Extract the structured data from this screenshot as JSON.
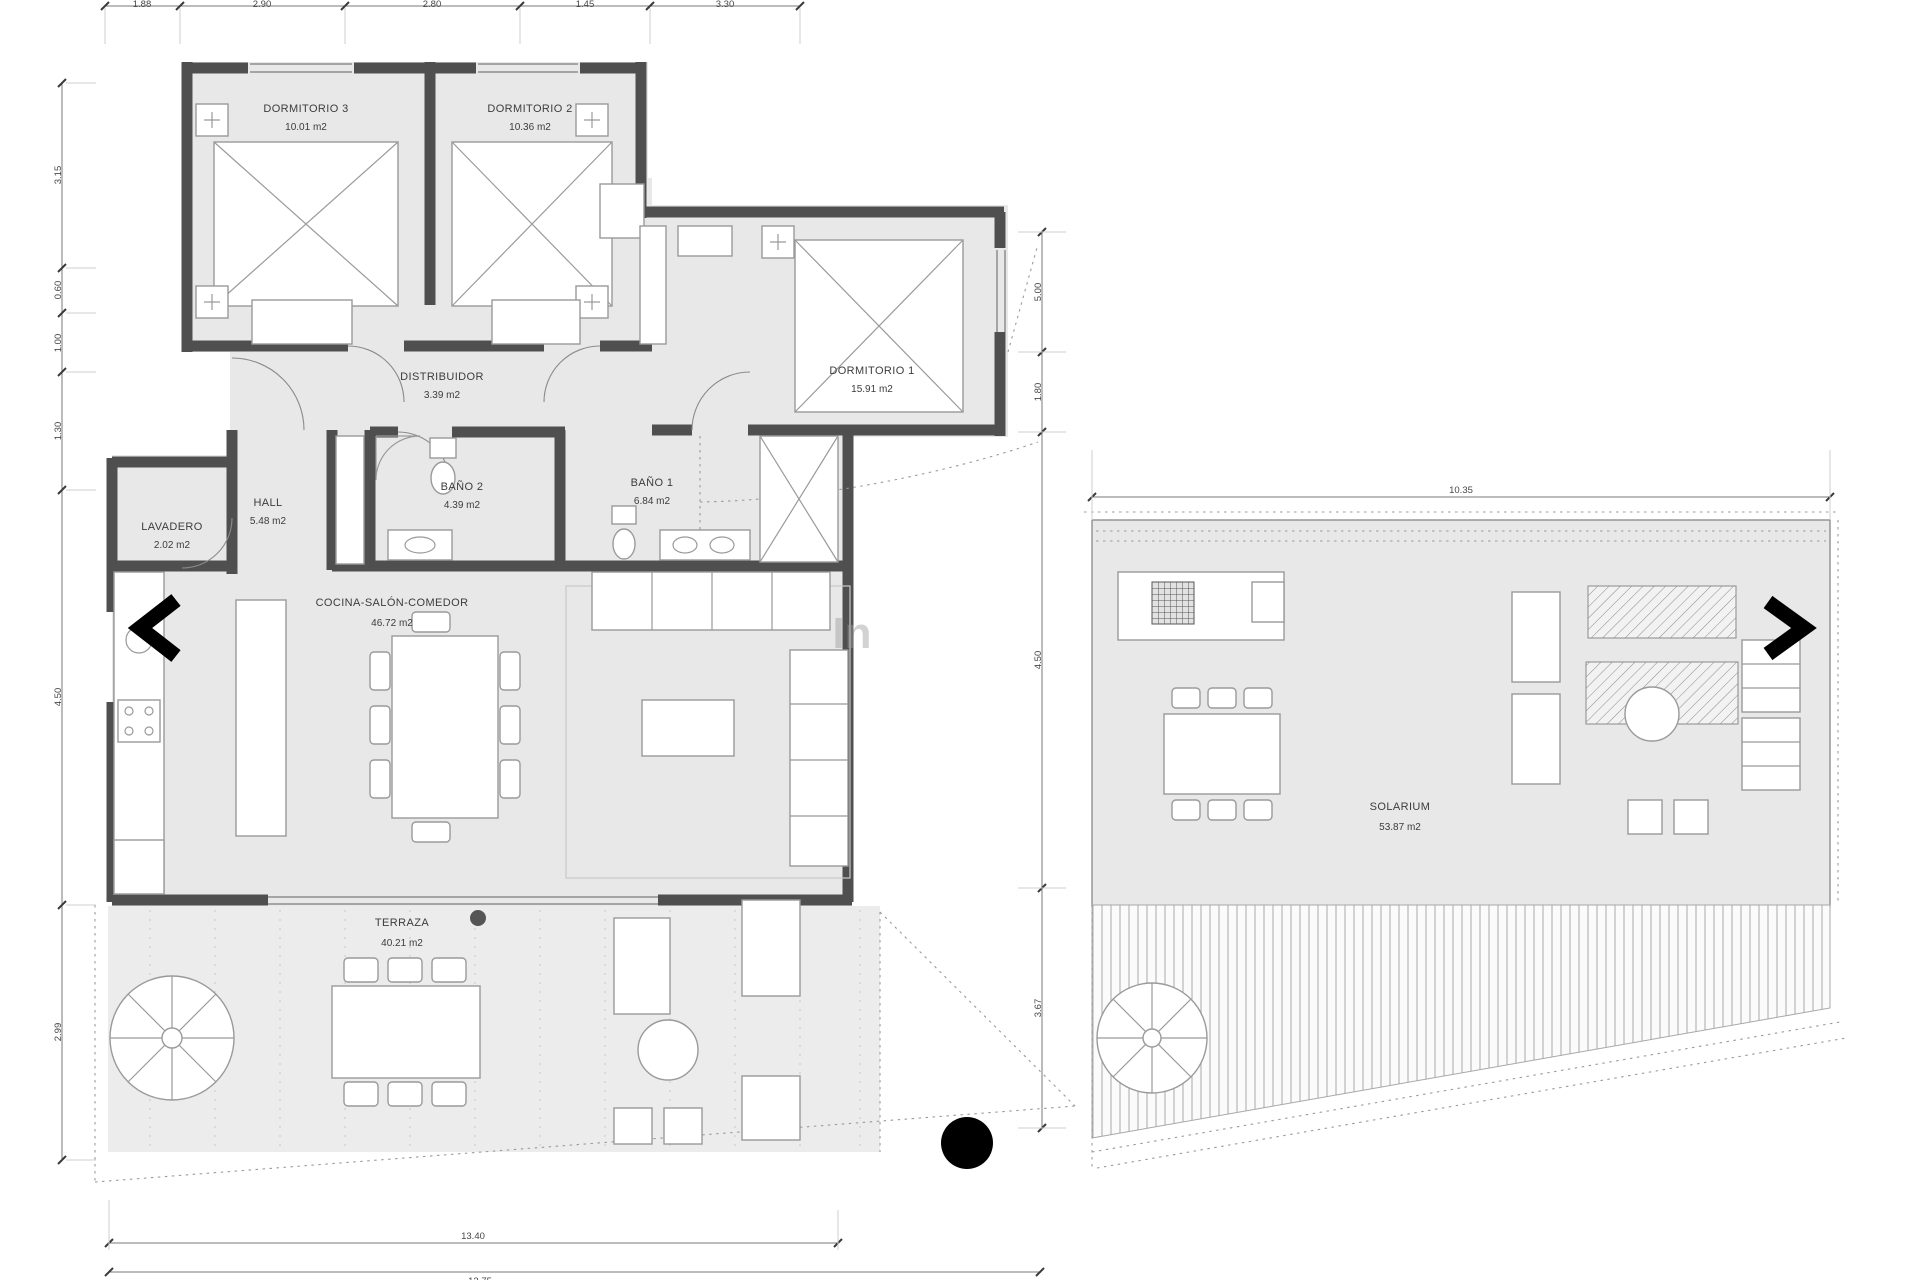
{
  "floor_plan": {
    "watermark": "In",
    "rooms": [
      {
        "name": "DORMITORIO 3",
        "area": "10.01 m2"
      },
      {
        "name": "DORMITORIO 2",
        "area": "10.36 m2"
      },
      {
        "name": "DORMITORIO 1",
        "area": "15.91 m2"
      },
      {
        "name": "DISTRIBUIDOR",
        "area": "3.39 m2"
      },
      {
        "name": "HALL",
        "area": "5.48 m2"
      },
      {
        "name": "LAVADERO",
        "area": "2.02 m2"
      },
      {
        "name": "BAÑO 2",
        "area": "4.39 m2"
      },
      {
        "name": "BAÑO 1",
        "area": "6.84 m2"
      },
      {
        "name": "COCINA-SALÓN-COMEDOR",
        "area": "46.72 m2"
      },
      {
        "name": "TERRAZA",
        "area": "40.21 m2"
      }
    ],
    "dimensions": {
      "top": [
        "1.88",
        "2.90",
        "2.80",
        "1.45",
        "3.30"
      ],
      "left": [
        "3.15",
        "0.60",
        "1.00",
        "1.30",
        "4.50",
        "2.99"
      ],
      "middle": [
        "5.00",
        "1.80",
        "4.50",
        "3.67"
      ],
      "bottom": "13.40",
      "bottom2": "13.75"
    }
  },
  "roof_plan": {
    "rooms": [
      {
        "name": "SOLARIUM",
        "area": "53.87 m2"
      }
    ],
    "dimensions": {
      "top": "10.35"
    }
  },
  "colors": {
    "floor_fill": "#e8e8e8",
    "wall": "#4f4f4f",
    "furniture_line": "#9a9a9a",
    "ink": "#3c3c3c",
    "marker_black": "#000000"
  }
}
